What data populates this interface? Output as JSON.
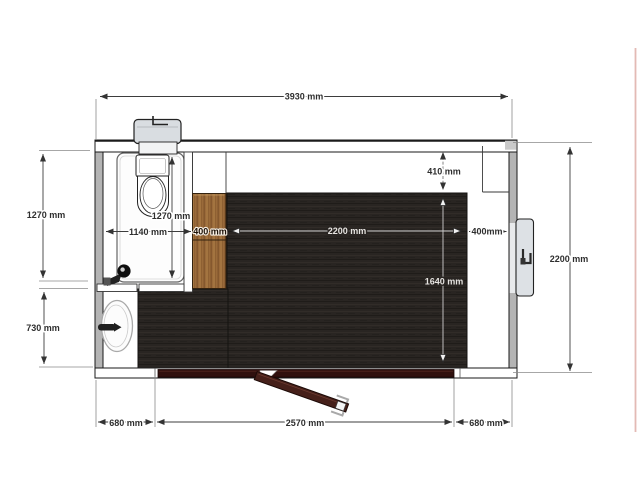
{
  "page": {
    "background": "#ffffff",
    "edge_accent_color": "#e3bab5"
  },
  "floorplan": {
    "description": "top-view floor plan of portable sanitary cabin with WC room, basin, cabinet and entrance door",
    "colors": {
      "floor_dark": "#292522",
      "cabinet_wood": "#9a6a3a",
      "door_maroon": "#46201a",
      "wall_gray": "#b4b4b4",
      "fixture_gray": "#dde1e5",
      "dimension_line": "#3d3d3d"
    },
    "labels": {
      "overall_width": "3930 mm",
      "overall_height": "2200 mm",
      "wc_room_height_outer": "1270 mm",
      "wc_room_height_inner": "1270 mm",
      "wc_room_width": "1140 mm",
      "cabinet_width": "400 mm",
      "main_room_width": "2200 mm",
      "right_offset": "400mm",
      "top_offset": "410 mm",
      "main_room_depth": "1640 mm",
      "basin_zone_height": "730 mm",
      "bottom_left_offset": "680 mm",
      "door_opening_width": "2570 mm",
      "bottom_right_offset": "680 mm"
    }
  }
}
